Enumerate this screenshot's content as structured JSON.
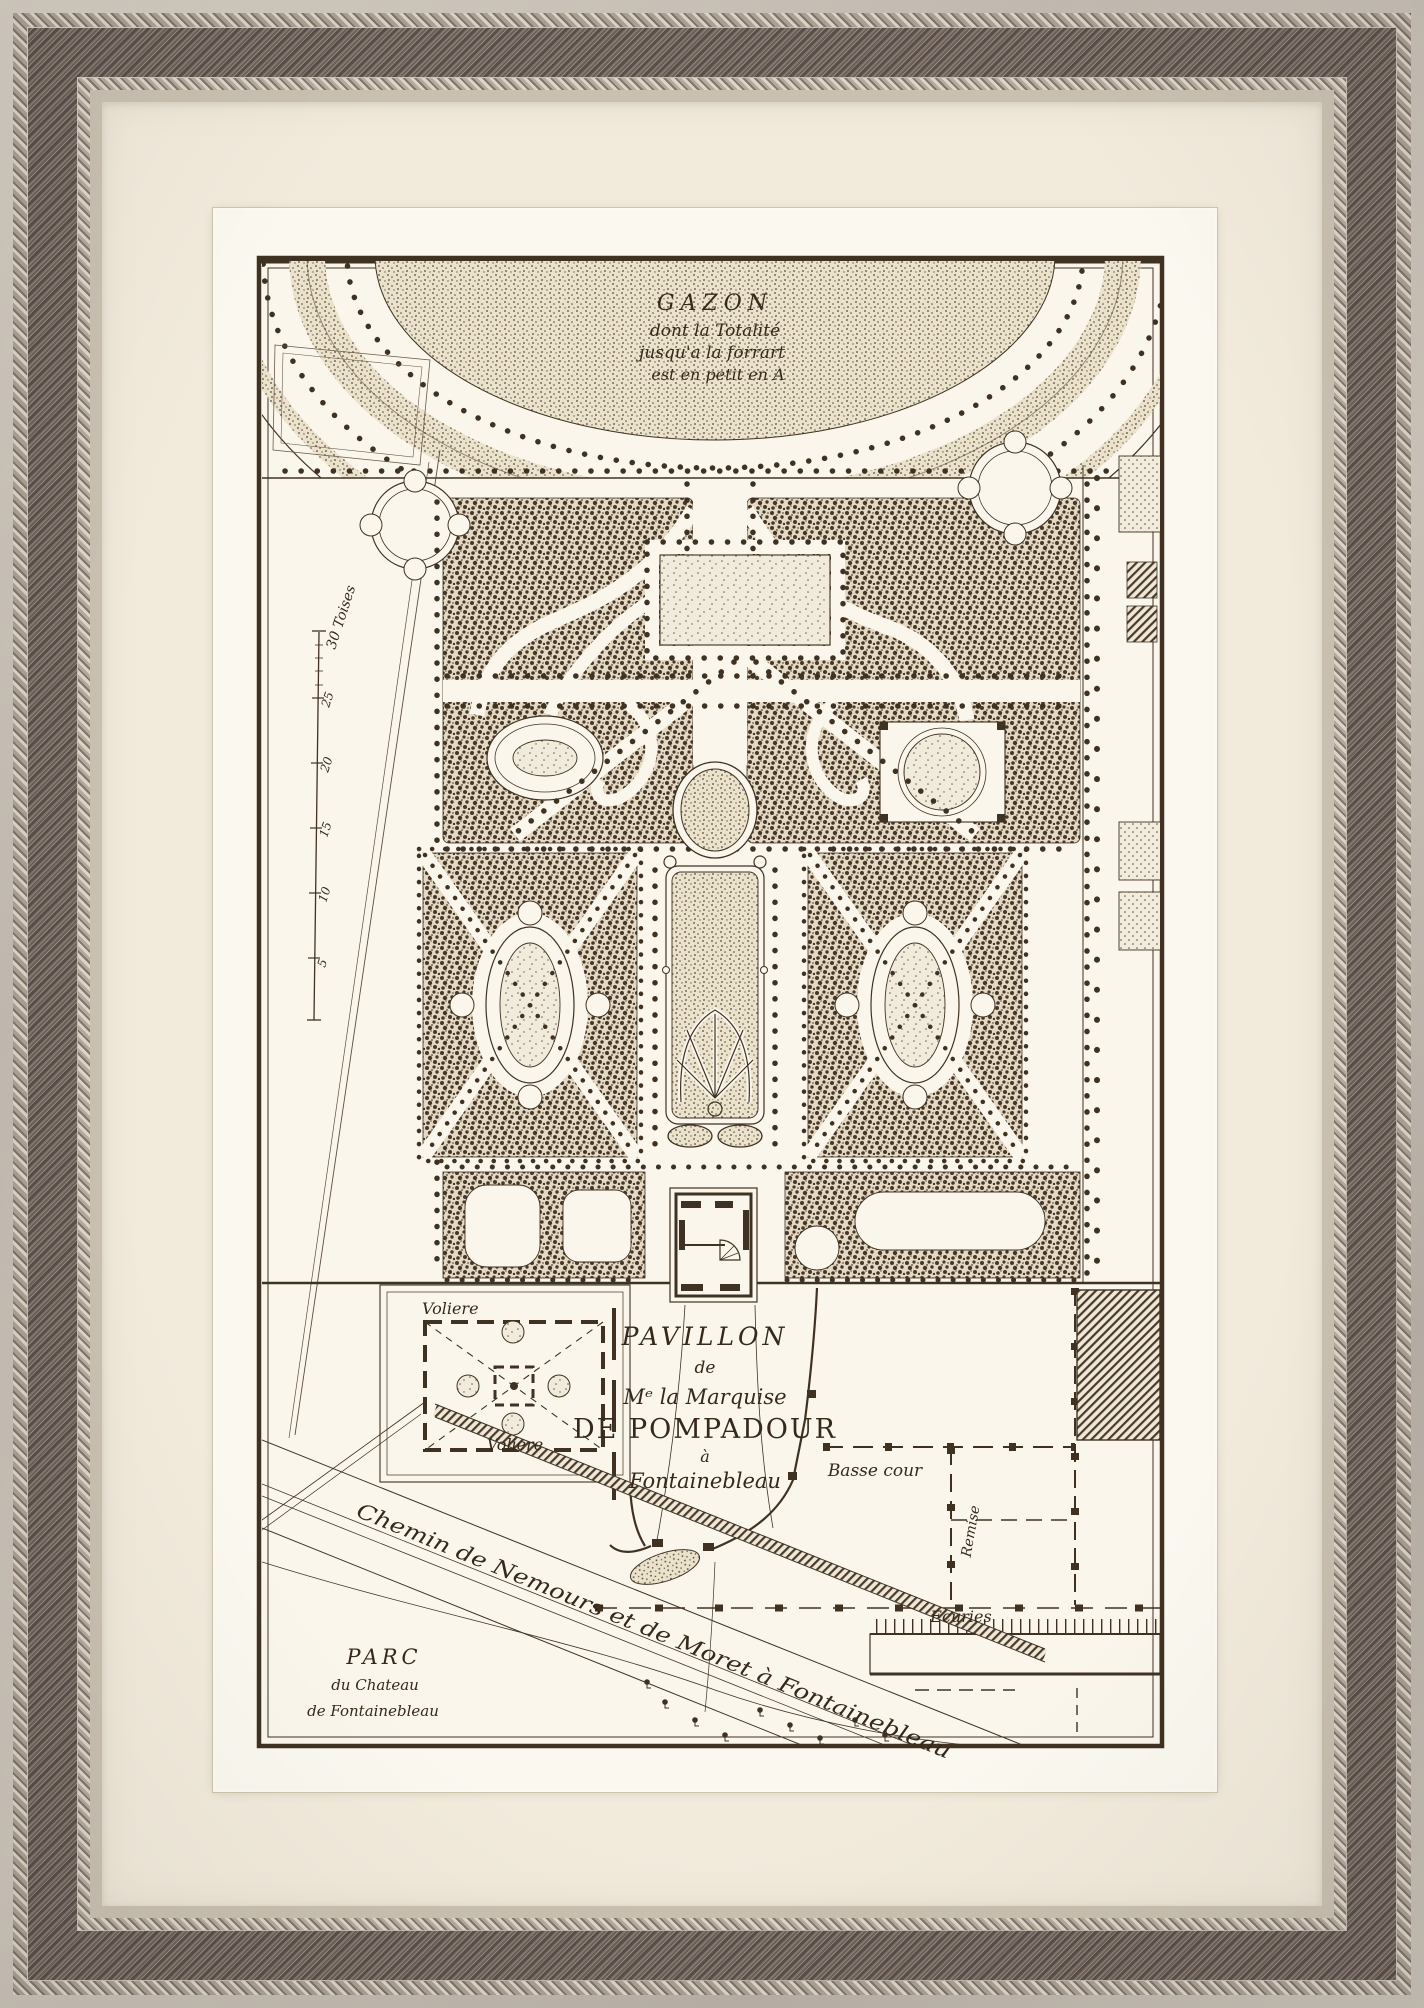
{
  "artwork": {
    "description": "Antique engraved garden plan in a silver-grey beaded frame with cream mat",
    "colors": {
      "frame_silver": "#c9c2b7",
      "frame_wood": "#6b5f59",
      "mat_cream": "#f2ebdc",
      "paper_white": "#fbf8f0",
      "plan_paper": "#faf6ec",
      "ink": "#3f3222",
      "stipple": "#46372a"
    }
  },
  "plan": {
    "gazon": {
      "title": "GAZON",
      "line2": "dont la Totalité",
      "line3": "jusqu'a la forrart",
      "line4": "est en petit en A"
    },
    "title_block": {
      "line1": "PAVILLON",
      "line2": "de",
      "line3": "Mᵉ la Marquise",
      "line4": "DE POMPADOUR",
      "line5": "à",
      "line6": "Fontainebleau"
    },
    "labels": {
      "voliere_top": "Voliere",
      "voliere_bottom": "Voliere",
      "basse_cour": "Basse cour",
      "remise": "Remise",
      "ecuries": "Ecuries",
      "road": "Chemin de Nemours et de Moret à Fontainebleau",
      "parc_line1": "PARC",
      "parc_line2": "du Chateau",
      "parc_line3": "de Fontainebleau"
    },
    "scale_bar": {
      "title": "30 Toises",
      "ticks": [
        "25",
        "20",
        "15",
        "10",
        "5"
      ]
    }
  }
}
